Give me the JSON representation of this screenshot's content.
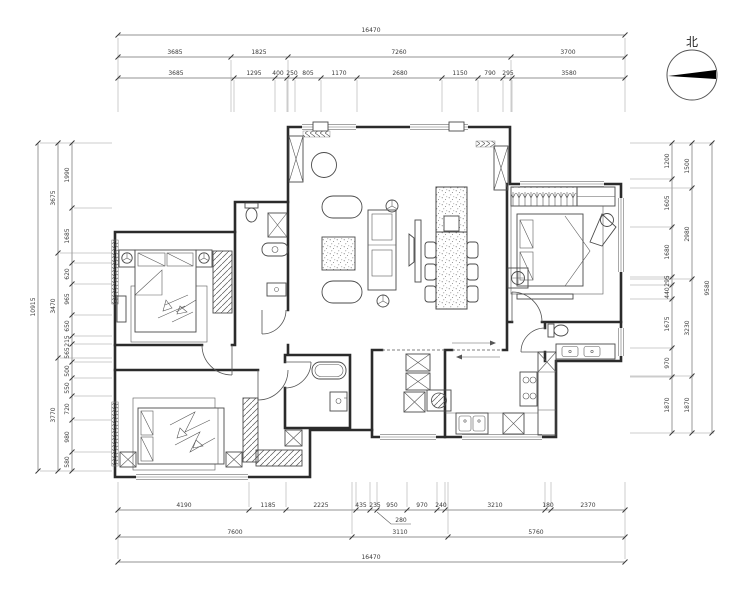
{
  "compass": {
    "label": "北"
  },
  "colors": {
    "wall": "#2b2b2b",
    "furniture": "#4a4a4a",
    "dimension_line": "#707070",
    "dimension_text": "#3a3a3a",
    "north_needle": "#000000",
    "background": "#ffffff"
  },
  "dimensions": {
    "top": {
      "overall": "16470",
      "row2": [
        "3685",
        "1825",
        "7260",
        "3700"
      ],
      "row3": [
        "3685",
        "1295",
        "400",
        "250",
        "805",
        "1170",
        "2680",
        "1150",
        "790",
        "295",
        "3580"
      ]
    },
    "bottom": {
      "row1": [
        "4190",
        "1185",
        "2225",
        "435",
        "235",
        "950",
        "970",
        "240",
        "3210",
        "180",
        "2370"
      ],
      "leader_value": "280",
      "row2": [
        "7600",
        "3110",
        "5760"
      ],
      "overall": "16470"
    },
    "left": {
      "overall": "10915",
      "mid": [
        "3675",
        "3470",
        "3770"
      ],
      "inner": [
        "1990",
        "1685",
        "620",
        "965",
        "650",
        "215",
        "565",
        "500",
        "550",
        "720",
        "980",
        "580"
      ]
    },
    "right": {
      "overall": "9580",
      "mid": [
        "1500",
        "2980",
        "3230",
        "1870"
      ],
      "inner": [
        "1200",
        "1605",
        "1680",
        "295",
        "440",
        "1675",
        "970",
        "1870"
      ]
    }
  }
}
